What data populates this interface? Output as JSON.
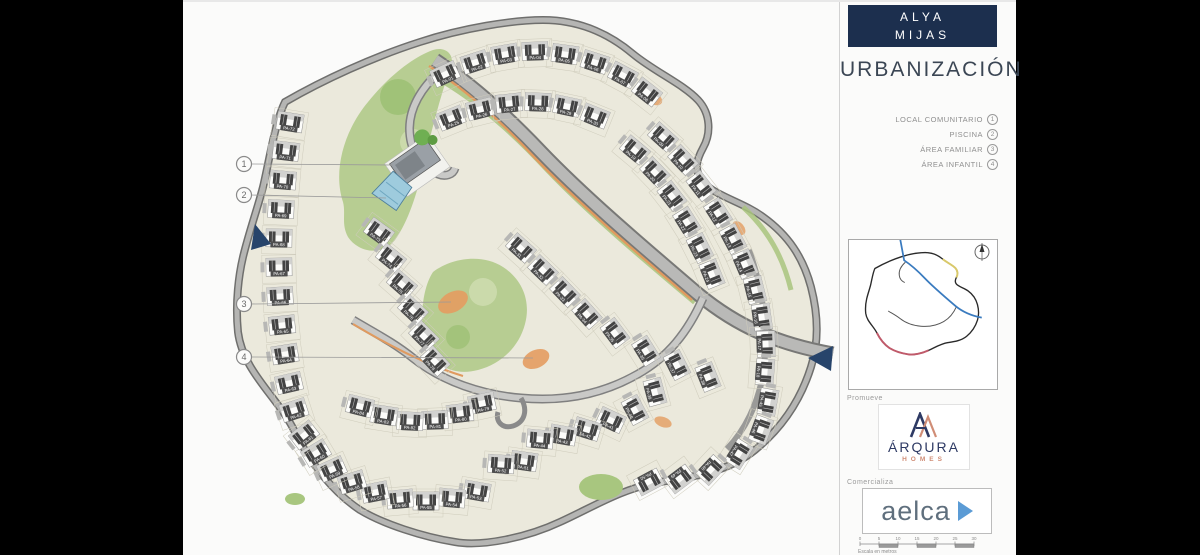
{
  "sidebar": {
    "project": {
      "line1": "ALYA",
      "line2": "MIJAS"
    },
    "title": "URBANIZACIÓN",
    "legend": [
      {
        "label": "LOCAL COMUNITARIO",
        "num": "1"
      },
      {
        "label": "PISCINA",
        "num": "2"
      },
      {
        "label": "ÁREA FAMILIAR",
        "num": "3"
      },
      {
        "label": "ÁREA INFANTIL",
        "num": "4"
      }
    ],
    "promoter_label": "Promueve",
    "promoter": {
      "name": "ÁRQURA",
      "sub": "HOMES"
    },
    "marketer_label": "Comercializa",
    "marketer": {
      "name": "aelca"
    },
    "scale": {
      "ticks": [
        "0",
        "5",
        "10",
        "15",
        "20",
        "25",
        "30"
      ],
      "caption": "Escala en metros"
    }
  },
  "plan": {
    "callouts": [
      {
        "num": "1",
        "x": 61,
        "y": 162,
        "tx": 210,
        "ty": 163
      },
      {
        "num": "2",
        "x": 61,
        "y": 193,
        "tx": 203,
        "ty": 196
      },
      {
        "num": "3",
        "x": 61,
        "y": 302,
        "tx": 268,
        "ty": 300
      },
      {
        "num": "4",
        "x": 61,
        "y": 355,
        "tx": 350,
        "ty": 356
      }
    ],
    "units": [
      {
        "id": "PA-01",
        "x": 262,
        "y": 72,
        "r": -25
      },
      {
        "id": "PA-02",
        "x": 292,
        "y": 60,
        "r": -18
      },
      {
        "id": "PA-03",
        "x": 322,
        "y": 52,
        "r": -10
      },
      {
        "id": "PA-04",
        "x": 352,
        "y": 49,
        "r": -2
      },
      {
        "id": "PA-05",
        "x": 382,
        "y": 52,
        "r": 8
      },
      {
        "id": "PA-06",
        "x": 412,
        "y": 60,
        "r": 18
      },
      {
        "id": "PA-07",
        "x": 440,
        "y": 73,
        "r": 28
      },
      {
        "id": "PA-08",
        "x": 464,
        "y": 90,
        "r": 38
      },
      {
        "id": "PA-09",
        "x": 480,
        "y": 135,
        "r": 42
      },
      {
        "id": "PA-10",
        "x": 500,
        "y": 158,
        "r": 47
      },
      {
        "id": "PA-11",
        "x": 518,
        "y": 184,
        "r": 52
      },
      {
        "id": "PA-12",
        "x": 535,
        "y": 211,
        "r": 57
      },
      {
        "id": "PA-13",
        "x": 550,
        "y": 237,
        "r": 62
      },
      {
        "id": "PA-14",
        "x": 562,
        "y": 262,
        "r": 67
      },
      {
        "id": "PA-15",
        "x": 572,
        "y": 288,
        "r": 76
      },
      {
        "id": "PA-16",
        "x": 579,
        "y": 315,
        "r": 82
      },
      {
        "id": "PA-17",
        "x": 583,
        "y": 342,
        "r": 88
      },
      {
        "id": "PA-18",
        "x": 582,
        "y": 370,
        "r": 94
      },
      {
        "id": "PA-19",
        "x": 452,
        "y": 148,
        "r": 40
      },
      {
        "id": "PA-20",
        "x": 472,
        "y": 170,
        "r": 46
      },
      {
        "id": "PA-21",
        "x": 489,
        "y": 194,
        "r": 52
      },
      {
        "id": "PA-22",
        "x": 504,
        "y": 220,
        "r": 58
      },
      {
        "id": "PA-23",
        "x": 517,
        "y": 246,
        "r": 63
      },
      {
        "id": "PA-24",
        "x": 529,
        "y": 272,
        "r": 68
      },
      {
        "id": "PA-25",
        "x": 268,
        "y": 116,
        "r": -22
      },
      {
        "id": "PA-26",
        "x": 297,
        "y": 107,
        "r": -14
      },
      {
        "id": "PA-27",
        "x": 326,
        "y": 101,
        "r": -6
      },
      {
        "id": "PA-28",
        "x": 355,
        "y": 100,
        "r": 2
      },
      {
        "id": "PA-29",
        "x": 384,
        "y": 104,
        "r": 12
      },
      {
        "id": "PA-30",
        "x": 412,
        "y": 114,
        "r": 22
      },
      {
        "id": "PA-31",
        "x": 338,
        "y": 246,
        "r": 42
      },
      {
        "id": "PA-32",
        "x": 360,
        "y": 268,
        "r": 44
      },
      {
        "id": "PA-33",
        "x": 382,
        "y": 290,
        "r": 46
      },
      {
        "id": "PA-34",
        "x": 404,
        "y": 312,
        "r": 48
      },
      {
        "id": "PA-35",
        "x": 432,
        "y": 331,
        "r": 53
      },
      {
        "id": "PA-36",
        "x": 463,
        "y": 349,
        "r": 58
      },
      {
        "id": "PA-37",
        "x": 494,
        "y": 363,
        "r": 63
      },
      {
        "id": "PA-38",
        "x": 525,
        "y": 375,
        "r": 68
      },
      {
        "id": "PA-39",
        "x": 472,
        "y": 390,
        "r": 75
      },
      {
        "id": "PA-40",
        "x": 452,
        "y": 408,
        "r": 62
      },
      {
        "id": "PA-41",
        "x": 428,
        "y": 418,
        "r": 25
      },
      {
        "id": "PA-42",
        "x": 404,
        "y": 427,
        "r": 17
      },
      {
        "id": "PA-43",
        "x": 380,
        "y": 433,
        "r": 10
      },
      {
        "id": "PA-44",
        "x": 357,
        "y": 437,
        "r": 5
      },
      {
        "id": "PA-45",
        "x": 585,
        "y": 400,
        "r": 100
      },
      {
        "id": "PA-46",
        "x": 578,
        "y": 428,
        "r": 110
      },
      {
        "id": "PA-47",
        "x": 556,
        "y": 452,
        "r": 122
      },
      {
        "id": "PA-48",
        "x": 528,
        "y": 468,
        "r": 133
      },
      {
        "id": "PA-49",
        "x": 497,
        "y": 477,
        "r": 143
      },
      {
        "id": "PA-50",
        "x": 466,
        "y": 480,
        "r": 152
      },
      {
        "id": "PA-51",
        "x": 341,
        "y": 459,
        "r": 8
      },
      {
        "id": "PA-52",
        "x": 318,
        "y": 462,
        "r": 4
      },
      {
        "id": "PA-53",
        "x": 294,
        "y": 489,
        "r": 10
      },
      {
        "id": "PA-54",
        "x": 269,
        "y": 496,
        "r": 5
      },
      {
        "id": "PA-55",
        "x": 243,
        "y": 499,
        "r": 0
      },
      {
        "id": "PA-56",
        "x": 217,
        "y": 497,
        "r": -5
      },
      {
        "id": "PA-57",
        "x": 192,
        "y": 490,
        "r": -11
      },
      {
        "id": "PA-58",
        "x": 169,
        "y": 480,
        "r": -17
      },
      {
        "id": "PA-59",
        "x": 149,
        "y": 467,
        "r": -24
      },
      {
        "id": "PA-60",
        "x": 133,
        "y": 451,
        "r": -31
      },
      {
        "id": "PA-61",
        "x": 121,
        "y": 433,
        "r": -38
      },
      {
        "id": "PA-62",
        "x": 111,
        "y": 408,
        "r": -18
      },
      {
        "id": "PA-63",
        "x": 106,
        "y": 381,
        "r": -13
      },
      {
        "id": "PA-64",
        "x": 102,
        "y": 352,
        "r": -9
      },
      {
        "id": "PA-65",
        "x": 99,
        "y": 323,
        "r": -6
      },
      {
        "id": "PA-66",
        "x": 97,
        "y": 294,
        "r": -3
      },
      {
        "id": "PA-67",
        "x": 96,
        "y": 265,
        "r": -1
      },
      {
        "id": "PA-68",
        "x": 96,
        "y": 236,
        "r": 1
      },
      {
        "id": "PA-69",
        "x": 98,
        "y": 207,
        "r": 3
      },
      {
        "id": "PA-70",
        "x": 100,
        "y": 178,
        "r": 5
      },
      {
        "id": "PA-71",
        "x": 103,
        "y": 149,
        "r": 7
      },
      {
        "id": "PA-72",
        "x": 107,
        "y": 120,
        "r": 9
      },
      {
        "id": "PA-73",
        "x": 196,
        "y": 230,
        "r": 36
      },
      {
        "id": "PA-74",
        "x": 208,
        "y": 256,
        "r": 39
      },
      {
        "id": "PA-75",
        "x": 219,
        "y": 282,
        "r": 41
      },
      {
        "id": "PA-76",
        "x": 230,
        "y": 308,
        "r": 43
      },
      {
        "id": "PA-77",
        "x": 241,
        "y": 334,
        "r": 45
      },
      {
        "id": "PA-78",
        "x": 252,
        "y": 359,
        "r": 47
      },
      {
        "id": "PA-79",
        "x": 299,
        "y": 401,
        "r": -12
      },
      {
        "id": "PA-80",
        "x": 277,
        "y": 411,
        "r": -7
      },
      {
        "id": "PA-81",
        "x": 252,
        "y": 418,
        "r": -2
      },
      {
        "id": "PA-82",
        "x": 227,
        "y": 419,
        "r": 3
      },
      {
        "id": "PA-83",
        "x": 201,
        "y": 413,
        "r": 9
      },
      {
        "id": "PA-84",
        "x": 177,
        "y": 404,
        "r": 14
      }
    ],
    "colors": {
      "navy": "#1c2f4e",
      "cream": "#ebe9dc",
      "road": "#b5b5b3",
      "road_edge": "#6f6f6d",
      "green": "#b7cd92",
      "green_dark": "#93b96d",
      "orange": "#e49c60",
      "pool_blue": "#9ecbdd",
      "unit_dark": "#434343",
      "chip": "#4e4e4e",
      "arrow_navy": "#27446b",
      "arqura_navy": "#2e3a64",
      "arqura_coral": "#d08d76",
      "aelca_slate": "#5f6f7d",
      "aelca_blue": "#5b9bd5",
      "minimap_blue": "#3a7bbf",
      "minimap_yellow": "#d9c96a",
      "minimap_red": "#c05a6a"
    }
  }
}
